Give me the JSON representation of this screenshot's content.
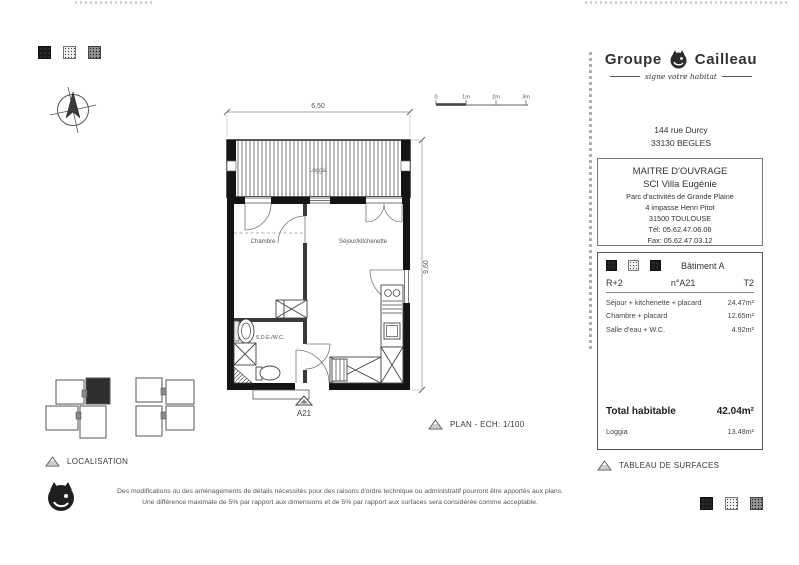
{
  "plan": {
    "rooms": {
      "loggia": "Loggia",
      "chambre": "Chambre",
      "sejour": "Séjour/kitchenette",
      "sde": "S.D.E./W.C."
    },
    "dims": {
      "width": "6,50",
      "height": "9,60"
    },
    "unit_marker": "A21",
    "caption": "PLAN - ECH: 1/100",
    "scalebar": [
      "0",
      "1m",
      "2m",
      "3m"
    ]
  },
  "localisation": {
    "caption": "LOCALISATION"
  },
  "company": {
    "name_left": "Groupe",
    "name_right": "Cailleau",
    "tagline": "signe votre habitat",
    "address": [
      "144 rue Durcy",
      "33130 BEGLES"
    ]
  },
  "maitre_ouvrage": {
    "title": "MAITRE D'OUVRAGE",
    "name": "SCI Villa Eugénie",
    "lines": [
      "Parc d'activités de Grande Plaine",
      "4 impasse Henri Pitot",
      "31500 TOULOUSE",
      "Tél: 05.62.47.06.06",
      "Fax: 05.62.47.03.12"
    ]
  },
  "surfaces": {
    "caption": "TABLEAU DE SURFACES",
    "building": "Bâtiment A",
    "floor": "R+2",
    "unit": "n°A21",
    "type": "T2",
    "rows": [
      {
        "label": "Séjour + kitchenette + placard",
        "value": "24.47m²"
      },
      {
        "label": "Chambre + placard",
        "value": "12.65m²"
      },
      {
        "label": "Salle d'eau + W.C.",
        "value": "4.92m²"
      }
    ],
    "total": {
      "label": "Total habitable",
      "value": "42.04m²"
    },
    "loggia": {
      "label": "Loggia",
      "value": "13.48m²"
    }
  },
  "disclaimer": {
    "line1": "Des modifications ou des aménagements de détails nécessités pour des raisons d'ordre technique ou administratif pourront être apportés aux plans.",
    "line2": "Une différence maximale de 5% par rapport aux dimensions et de 5% par rapport aux surfaces sera considérée comme acceptable."
  },
  "icons": {
    "compass": "compass-rose",
    "caption_marker": "hatched-triangle",
    "logo_mark": "cailleau-cat-in-circle",
    "swatches": [
      "dark-speckle",
      "light-speckle",
      "mid-speckle"
    ]
  },
  "colors": {
    "ink": "#3a3a3a",
    "wall": "#1a1a1a",
    "border_gray": "#777777"
  }
}
